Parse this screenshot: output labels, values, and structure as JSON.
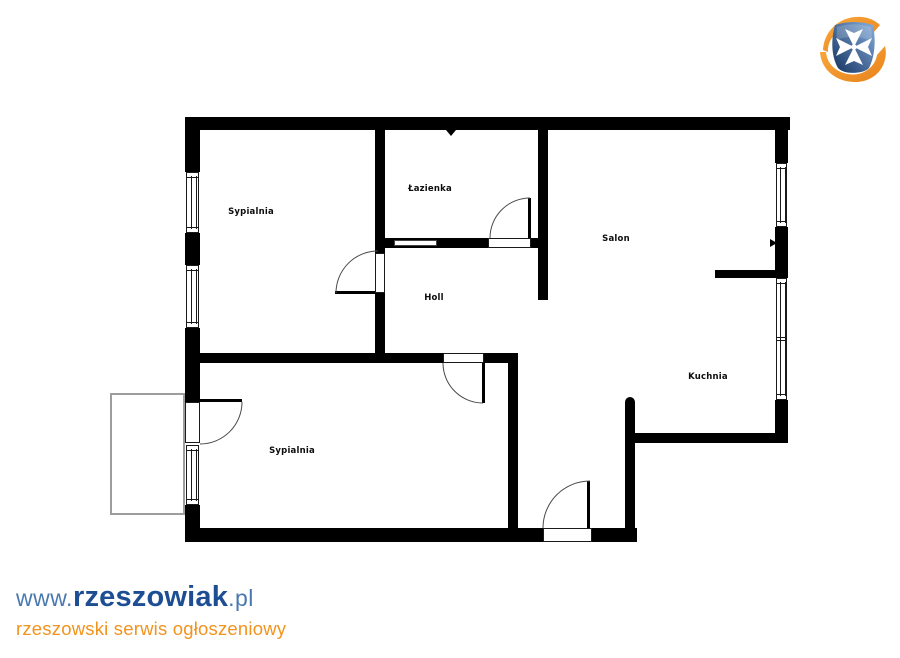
{
  "floorplan": {
    "rooms": [
      {
        "id": "sypialnia-1",
        "label": "Sypialnia"
      },
      {
        "id": "lazienka",
        "label": "Łazienka"
      },
      {
        "id": "holl",
        "label": "Holl"
      },
      {
        "id": "salon",
        "label": "Salon"
      },
      {
        "id": "kuchnia",
        "label": "Kuchnia"
      },
      {
        "id": "sypialnia-2",
        "label": "Sypialnia"
      }
    ],
    "wall_color": "#000000",
    "balcony_outline_color": "#9d9d9d",
    "background_color": "#ffffff"
  },
  "branding": {
    "logo_icon": "rzeszowiak-shield-cross-logo",
    "logo_colors": {
      "blue_light": "#86aede",
      "blue_dark": "#13315e",
      "orange_light": "#f9a93c",
      "orange_dark": "#e8821c",
      "cross": "#ffffff"
    },
    "watermark": {
      "prefix": "www.",
      "name": "rzeszowiak",
      "suffix": ".pl",
      "tagline": "rzeszowski serwis ogłoszeniowy",
      "colors": {
        "prefix": "#4a78b0",
        "name": "#1d4e94",
        "suffix": "#4a78b0",
        "tagline": "#f2931d"
      }
    }
  }
}
